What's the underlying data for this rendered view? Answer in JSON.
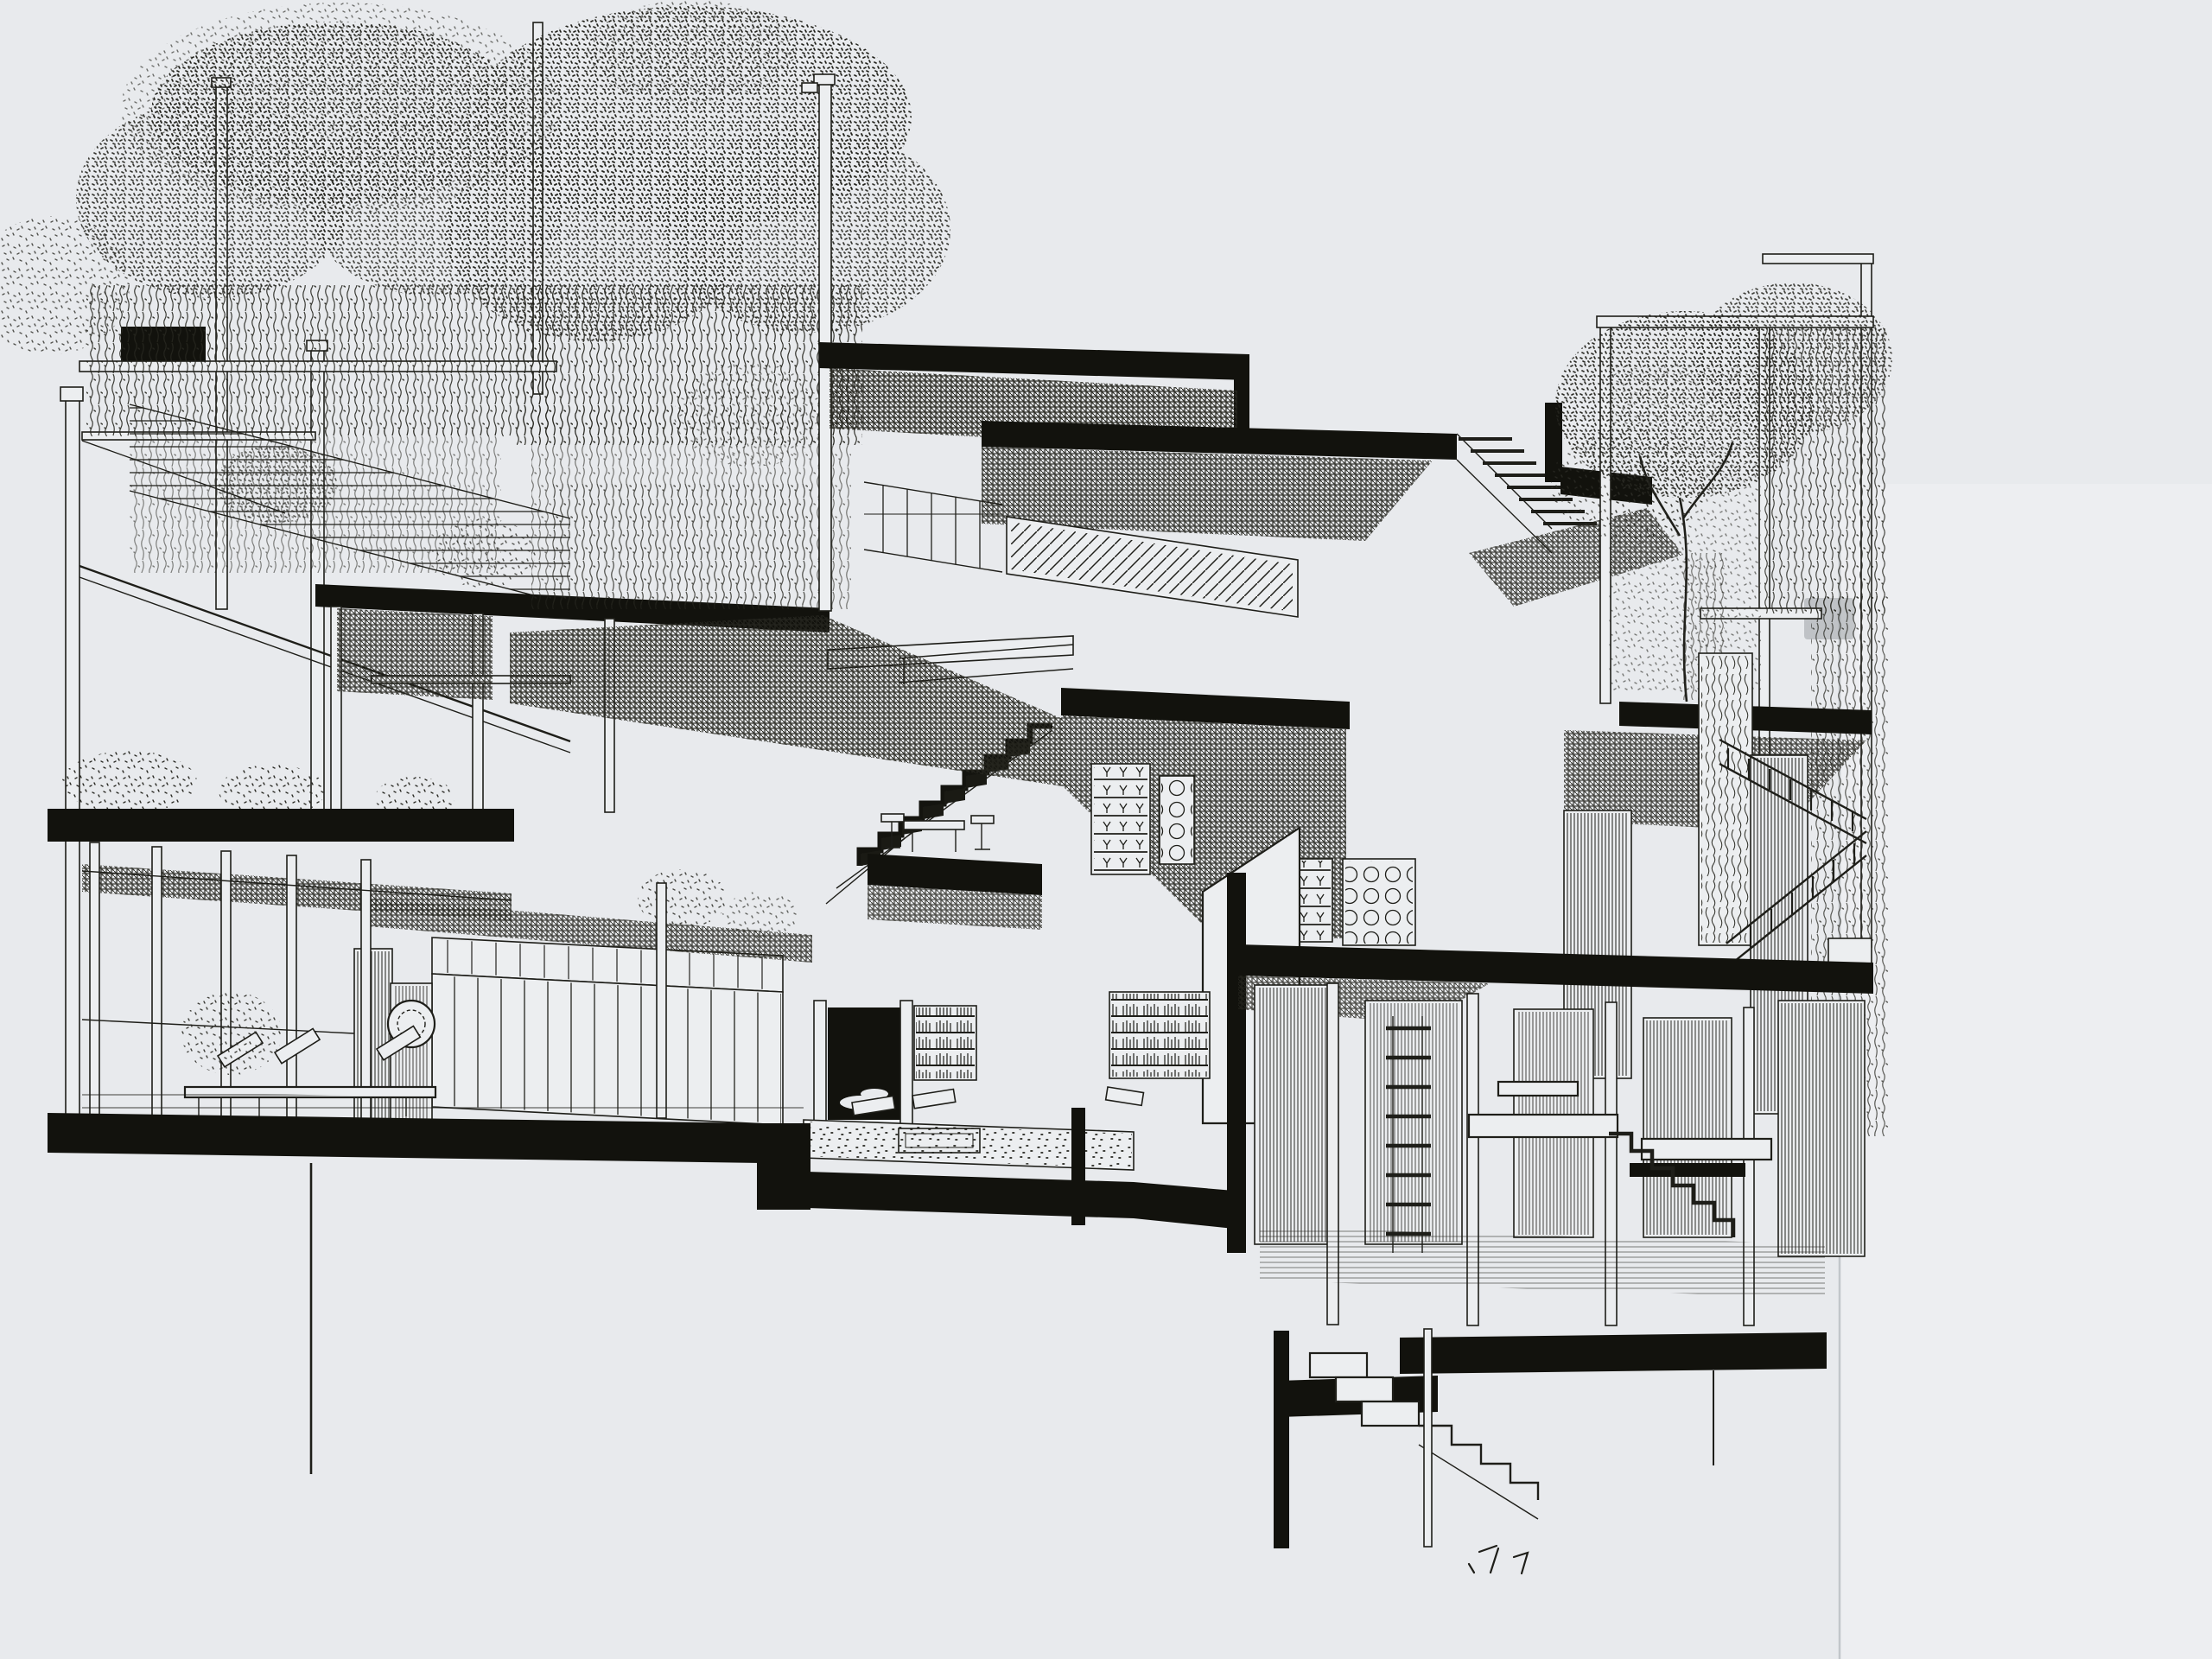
{
  "artwork": {
    "title": "Pen-and-ink sectional perspective drawing of a terraced multi-level house",
    "medium": "ink line drawing on paper, photographed slide"
  },
  "colors": {
    "paper": "#e8eaed",
    "paper_right_strip": "#eff0f2",
    "ink": "#1e1e19",
    "slab_black": "#12120d",
    "halftone": "#35352f",
    "smudge": "#8e9296"
  },
  "labels": {
    "drawing": "Sectional perspective of a split-level house with vine-covered pergolas, stacked black floor slabs, hatched ceilings, central stair, dining mezzanine, living hall with fireplace and library, right wing with exterior stair and basement, garden steps at bottom",
    "paper": "paper background",
    "left_pergola": "vine-draped pergola terrace wing",
    "wisteria_left": "weeping foliage over left pergola",
    "center_tree": "tall weeping tree at center",
    "roof_stack": "stepped roof slabs with hatched ceiling planes",
    "stair_hall": "double-height stair hall with open stair",
    "dining_mezzanine": "dining mezzanine slab with table and chairs",
    "pantry": "pantry shelves with glassware and perforated screens",
    "living_hall": "living hall with clerestory, plank wall and medallion pier",
    "fireplace": "fireplace inglenook",
    "library": "library bookshelves",
    "conversation_pit": "sunken conversation pit with cushions and rug",
    "veranda": "glazed veranda with daybed",
    "ground_slabs": "heavy black ground-floor slabs",
    "right_wing": "right wing with courtyard tree, exterior stair and bedrooms",
    "courtyard_tree": "courtyard tree in open frame",
    "exterior_stair": "exterior switch-back stair with climbing vines",
    "lower_rooms": "lower-level rooms with slatted partitions",
    "basement": "basement level and foundation slab",
    "garden_stair": "garden steps descending below grade",
    "scribble": "loose pen marks near lowest step",
    "photo_edge": "edge of photographed sheet"
  }
}
